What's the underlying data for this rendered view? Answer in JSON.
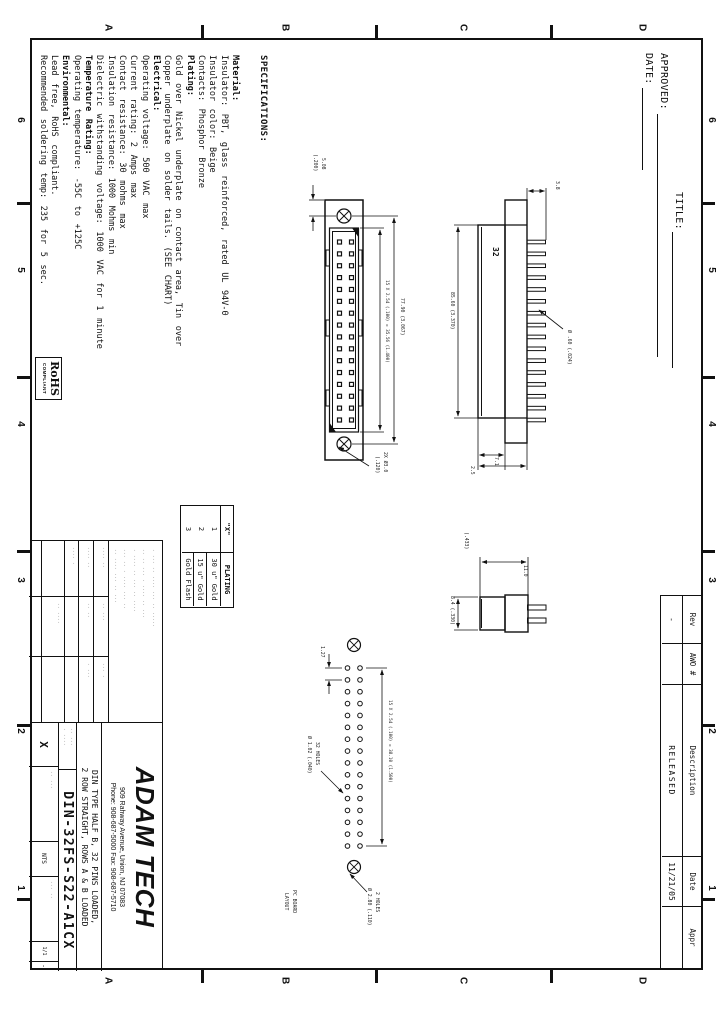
{
  "sheet": {
    "zone_columns": [
      "6",
      "5",
      "4",
      "3",
      "2",
      "1"
    ],
    "zone_rows": [
      "D",
      "C",
      "B",
      "A"
    ],
    "header": {
      "title_label": "TITLE:",
      "approved_label": "APPROVED:",
      "date_label": "DATE:"
    },
    "revision_table": {
      "headers": [
        "Rev",
        "AWO #",
        "Description",
        "Date",
        "Appr"
      ],
      "row": [
        "-",
        "",
        "RELEASED",
        "11/21/05",
        ""
      ]
    },
    "specifications": {
      "heading": "SPECIFICATIONS:",
      "lines": [
        {
          "text": "Material:",
          "bold": true
        },
        {
          "text": "Insulator: PBT, glass reinforced, rated UL 94V-0",
          "bold": false
        },
        {
          "text": "Insulator color: Beige",
          "bold": false
        },
        {
          "text": "Contacts: Phosphor Bronze",
          "bold": false
        },
        {
          "text": "Plating:",
          "bold": true
        },
        {
          "text": "Gold over Nickel underplate on contact area, Tin over",
          "bold": false
        },
        {
          "text": "Copper underplate on solder tails. (SEE CHART)",
          "bold": false
        },
        {
          "text": "Electrical:",
          "bold": true
        },
        {
          "text": "Operating voltage: 500 VAC max",
          "bold": false
        },
        {
          "text": "Current rating: 2 Amps max",
          "bold": false
        },
        {
          "text": "Contact resistance: 30 mohms max",
          "bold": false
        },
        {
          "text": "Insulation resistance: 1000 Mohms min",
          "bold": false
        },
        {
          "text": "Dielectric withstanding voltage: 1000 VAC for 1 minute",
          "bold": false
        },
        {
          "text": "Temperature Rating:",
          "bold": true
        },
        {
          "text": "Operating temperature: -55C to +125C",
          "bold": false
        },
        {
          "text": "Environmental:",
          "bold": true
        },
        {
          "text": "Lead free, RoHS compliant.",
          "bold": false
        },
        {
          "text": "Recommended soldering temp: 235 for 5 sec.",
          "bold": false
        }
      ]
    },
    "plating_table": {
      "col1_header": "\"X\"",
      "col2_header": "PLATING",
      "rows": [
        [
          "1",
          "30 u\" Gold"
        ],
        [
          "2",
          "15 u\" Gold"
        ],
        [
          "3",
          "Gold Flash"
        ]
      ]
    },
    "rohs_badge": {
      "line1": "RoHS",
      "line2": "COMPLIANT"
    },
    "title_block": {
      "logo": "ADAM TECH",
      "address_line1": "909 Rahway Avenue, Union, NJ 07083",
      "address_line2": "Phone: 908-687-5000 Fax: 908-687-5710",
      "description_line1": "DIN TYPE HALF B, 32 PINS LOADED,",
      "description_line2": "2 ROW STRAIGHT, ROWS A & B LOADED",
      "part_number": "DIN-32FS-S22-A1CX",
      "rev_letter": "X",
      "scale_value": "NTS",
      "sheet_value": "1/1",
      "dash": "-"
    },
    "views": {
      "front": {
        "pins_per_row": 16,
        "pin_rows": 2,
        "mount_holes": 2
      },
      "side": {
        "marking": "32",
        "teeth": 16
      },
      "footprint": {
        "holes_per_row": 16,
        "hole_rows": 2
      },
      "dim_labels": {
        "front": [
          "77.90 (3.067)",
          "15 X 2.54 (.100) = 35.56 (1.400)",
          "5.08",
          "(.200)",
          "2X Ø3.0",
          "(.120)"
        ],
        "side": [
          "85.60 (3.370)",
          "Ø .60 (.024)",
          "3.8",
          "7.1",
          "2.5"
        ],
        "profile": [
          "8.4 (.330)",
          "11.0",
          "(.433)"
        ],
        "footprint": [
          "15 X 2.54 (.100) = 38.10 (1.500)",
          "1.27",
          "32 HOLES",
          "Ø 1.02 (.040)",
          "2 HOLES",
          "Ø 2.80 (.110)",
          "PC BOARD",
          "LAYOUT"
        ]
      }
    },
    "microtext": {
      "tolerance_rows": [
        "· ··· ·· ···· ··· ·· ·····",
        "·· ·· ··· · ···· ·· ···",
        "· ···· ·· ··· ·· ····",
        "··· ·· · ···· ··· ··",
        "·· ···· ··· ·· ···"
      ],
      "tolerance_cells": [
        "···· ··",
        "·· ···",
        "··· ·",
        "···· ··",
        "·· ··",
        "· ···",
        "···· ·",
        "·· ····"
      ],
      "pn_cell": [
        "·· ···",
        "· ····"
      ],
      "bottom_cells": [
        "·· ···",
        "··· ··"
      ]
    }
  }
}
